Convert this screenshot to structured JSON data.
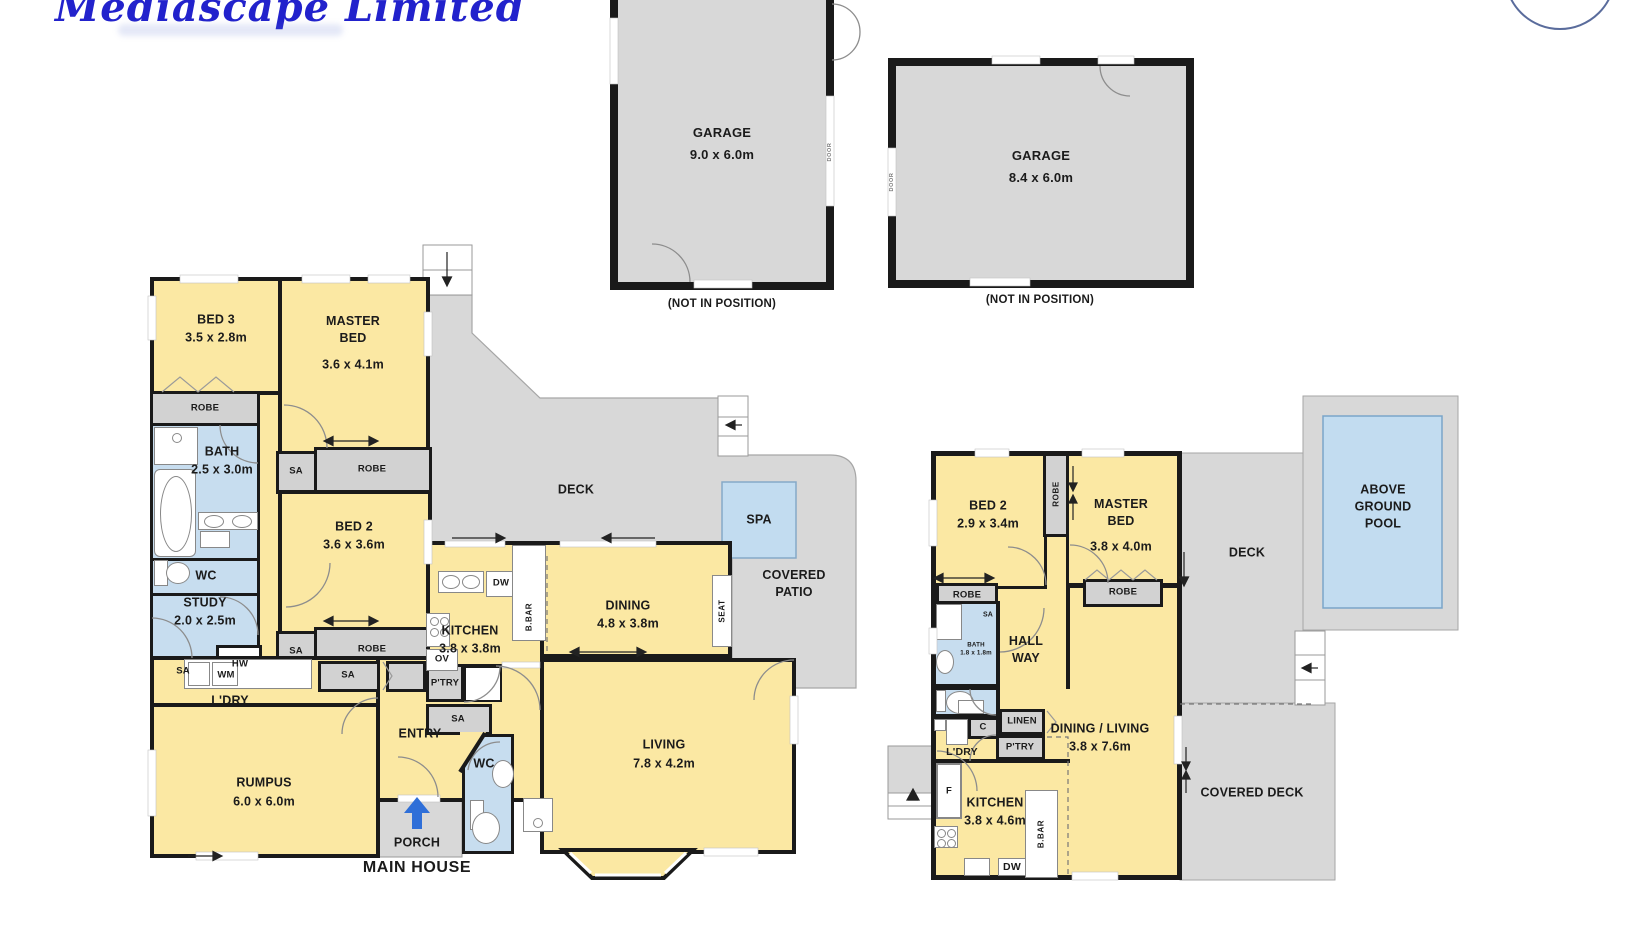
{
  "logo": {
    "text": "Mediascape Limited"
  },
  "garages": {
    "g1": {
      "name": "GARAGE",
      "dims": "9.0 x 6.0m",
      "note": "(NOT IN POSITION)",
      "door": "DOOR"
    },
    "g2": {
      "name": "GARAGE",
      "dims": "8.4 x 6.0m",
      "note": "(NOT IN POSITION)",
      "door": "DOOR"
    }
  },
  "main_house": {
    "caption": "MAIN HOUSE",
    "bed3": {
      "name": "BED 3",
      "dims": "3.5 x 2.8m"
    },
    "master": {
      "name": "MASTER BED",
      "dims": "3.6 x 4.1m"
    },
    "bed2": {
      "name": "BED 2",
      "dims": "3.6 x 3.6m"
    },
    "bath": {
      "name": "BATH",
      "dims": "2.5 x 3.0m"
    },
    "wc": "WC",
    "study": {
      "name": "STUDY",
      "dims": "2.0 x 2.5m"
    },
    "rumpus": {
      "name": "RUMPUS",
      "dims": "6.0 x 6.0m"
    },
    "kitchen": {
      "name": "KITCHEN",
      "dims": "3.8 x 3.8m"
    },
    "dining": {
      "name": "DINING",
      "dims": "4.8 x 3.8m"
    },
    "living": {
      "name": "LIVING",
      "dims": "7.8 x 4.2m"
    },
    "entry": "ENTRY",
    "porch": "PORCH",
    "ldry": "L'DRY",
    "robe": "ROBE",
    "sa": "SA",
    "hw": "HW",
    "wm": "WM",
    "dw": "DW",
    "ov": "OV",
    "bbar": "B.BAR",
    "ptry": "P'TRY",
    "seat": "SEAT",
    "deck": "DECK",
    "spa": "SPA",
    "covered_patio": "COVERED PATIO"
  },
  "minor_house": {
    "bed2": {
      "name": "BED 2",
      "dims": "2.9 x 3.4m"
    },
    "master": {
      "name": "MASTER BED",
      "dims": "3.8 x 4.0m"
    },
    "bath": {
      "name": "BATH",
      "dims": "1.8 x 1.8m"
    },
    "hallway": "HALL WAY",
    "ldry": "L'DRY",
    "c": "C",
    "linen": "LINEN",
    "ptry": "P'TRY",
    "dining_living": {
      "name": "DINING / LIVING",
      "dims": "3.8 x 7.6m"
    },
    "kitchen": {
      "name": "KITCHEN",
      "dims": "3.8 x 4.6m"
    },
    "f": "F",
    "dw": "DW",
    "bbar": "B.BAR",
    "sa": "SA",
    "robe": "ROBE",
    "deck": "DECK",
    "covered_deck": "COVERED DECK",
    "pool": "ABOVE GROUND POOL"
  },
  "colors": {
    "room_yellow": "#FBE8A3",
    "wet_blue": "#C7DDEF",
    "outdoor_gray": "#D8D8D8",
    "storage_gray": "#D2D2D2",
    "water_blue": "#C2DCF0",
    "wall": "#1A1A1A",
    "porch_arrow_blue": "#2F6FD8",
    "logo_blue": "#2222CC"
  }
}
